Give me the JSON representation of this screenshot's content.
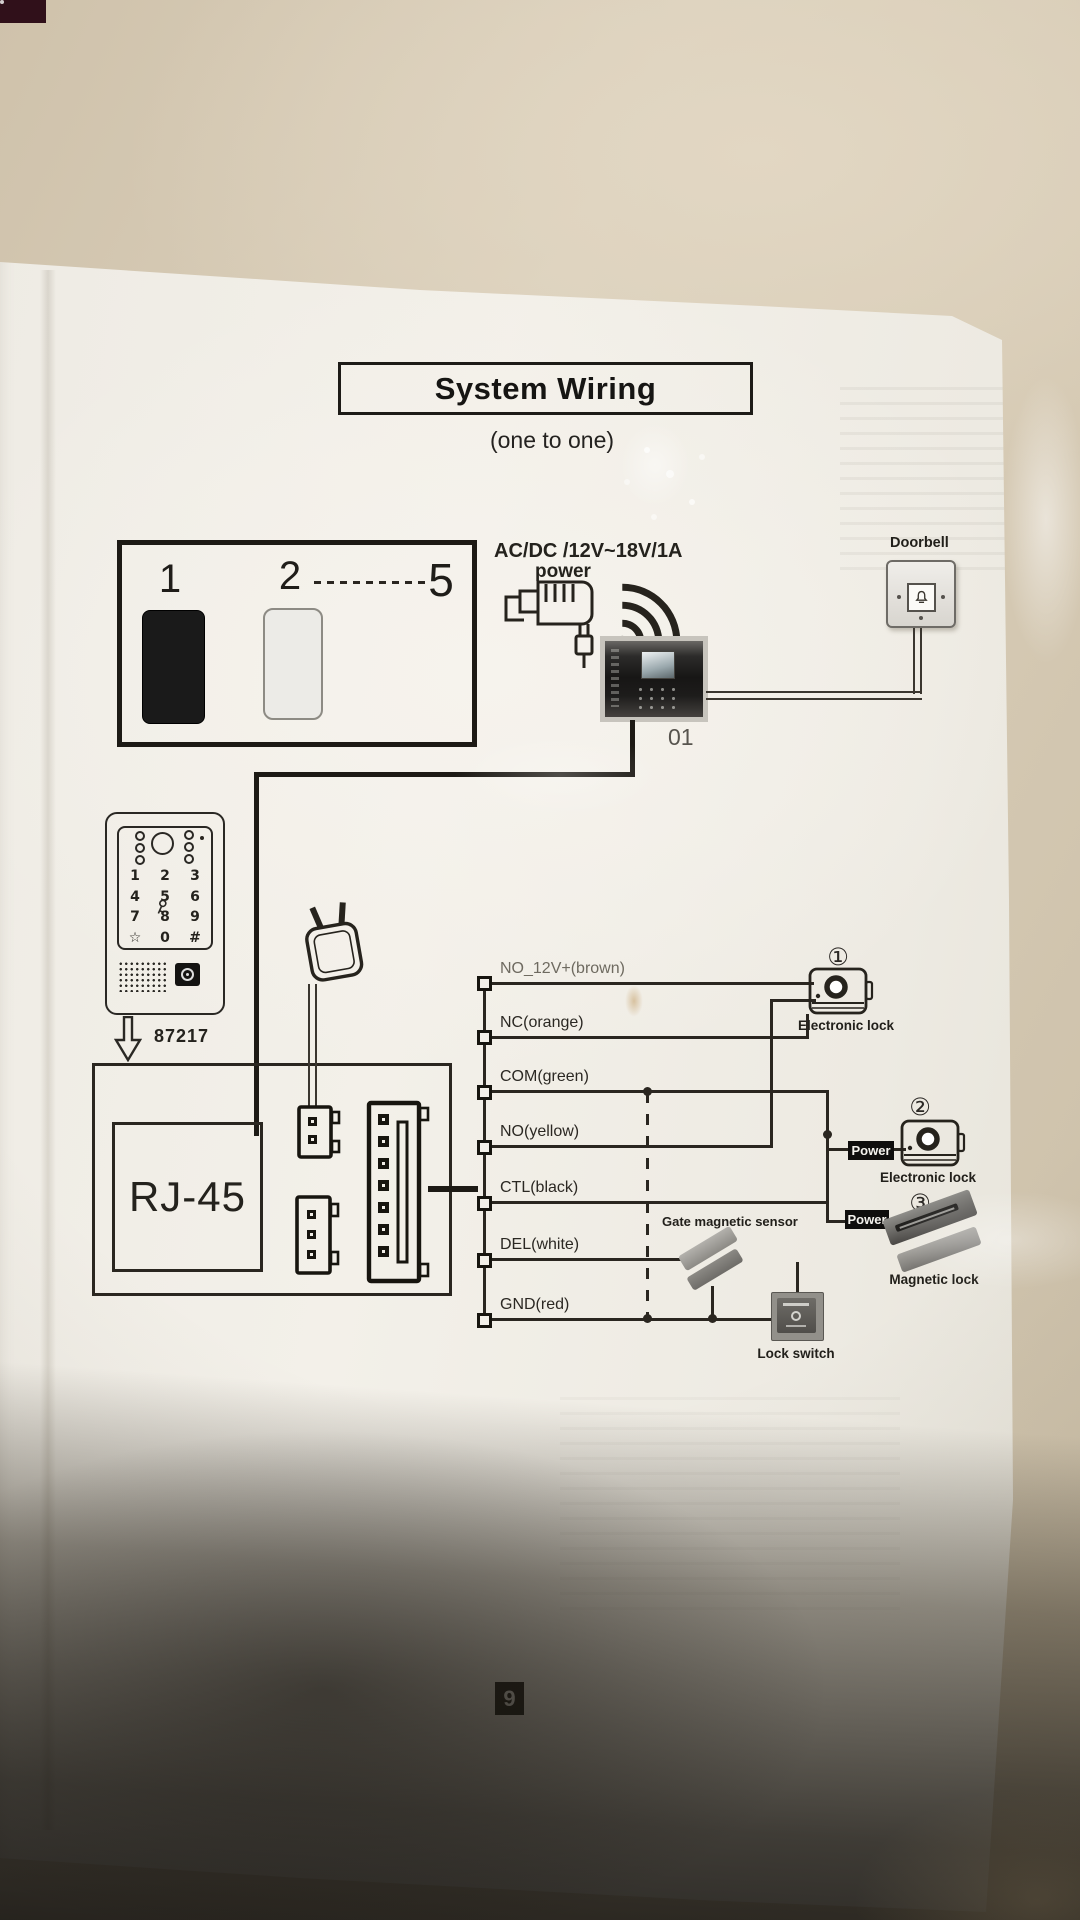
{
  "header": {
    "title": "System Wiring",
    "subtitle": "(one to one)"
  },
  "monitor_box": {
    "first": "1",
    "second": "2",
    "last": "5"
  },
  "power_supply": {
    "spec": "AC/DC /12V~18V/1A",
    "label": "power"
  },
  "door_station": {
    "id": "01"
  },
  "doorbell": {
    "label": "Doorbell"
  },
  "keypad": {
    "model": "87217",
    "keys": [
      "1",
      "2",
      "3",
      "4",
      "5",
      "6",
      "7",
      "8",
      "9",
      "☆",
      "0",
      "#"
    ]
  },
  "rj45": {
    "label": "RJ-45"
  },
  "wires": [
    "NO_12V+(brown)",
    "NC(orange)",
    "COM(green)",
    "NO(yellow)",
    "CTL(black)",
    "DEL(white)",
    "GND(red)"
  ],
  "locks": {
    "num1": "①",
    "label1": "Electronic lock",
    "num2": "②",
    "label2": "Electronic lock",
    "power2": "Power",
    "num3": "③",
    "label3": "Magnetic lock",
    "power3": "Power"
  },
  "sensor_label": "Gate magnetic sensor",
  "lock_switch_label": "Lock switch",
  "page_number": "9",
  "colors": {
    "ink": "#2a2620",
    "paper": "#f2efe8",
    "table": "#d7cbb6",
    "badge": "#0f0e0d"
  }
}
